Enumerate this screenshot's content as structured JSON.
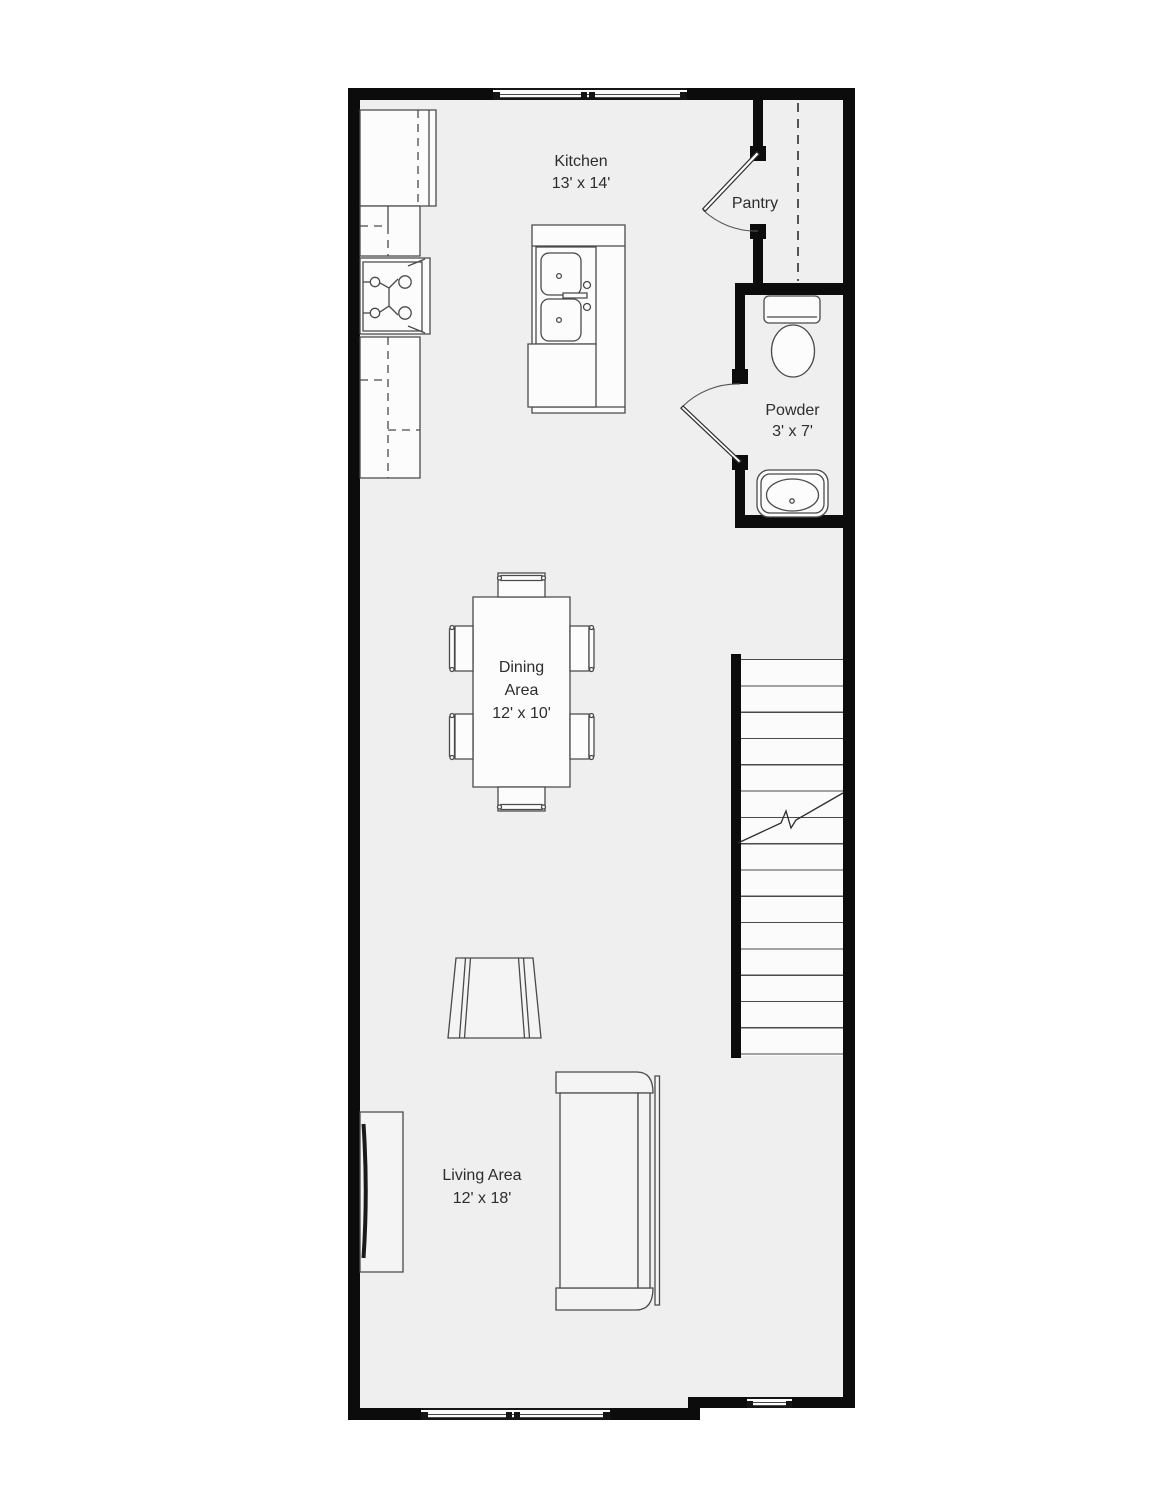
{
  "plan": {
    "type": "floor-plan",
    "colors": {
      "background": "#ffffff",
      "floor": "#efefef",
      "wall": "#0c0c0c",
      "furniture_line": "#4a4a4a",
      "text": "#2d2d2d"
    }
  },
  "rooms": {
    "kitchen": {
      "name": "Kitchen",
      "dims": "13' x 14'"
    },
    "pantry": {
      "name": "Pantry"
    },
    "powder": {
      "name": "Powder",
      "dims": "3' x 7'"
    },
    "dining": {
      "name_line1": "Dining",
      "name_line2": "Area",
      "dims": "12' x 10'"
    },
    "living": {
      "name": "Living Area",
      "dims": "12' x 18'"
    }
  },
  "fixtures": [
    "refrigerator",
    "kitchen-counter",
    "stove",
    "kitchen-island",
    "kitchen-sink",
    "dishwasher",
    "pantry-door",
    "powder-door",
    "toilet",
    "bathroom-sink",
    "stairs",
    "dining-table",
    "dining-chairs",
    "armchair",
    "sofa",
    "tv-console",
    "window-top",
    "window-bottom-left",
    "window-bottom-right"
  ]
}
